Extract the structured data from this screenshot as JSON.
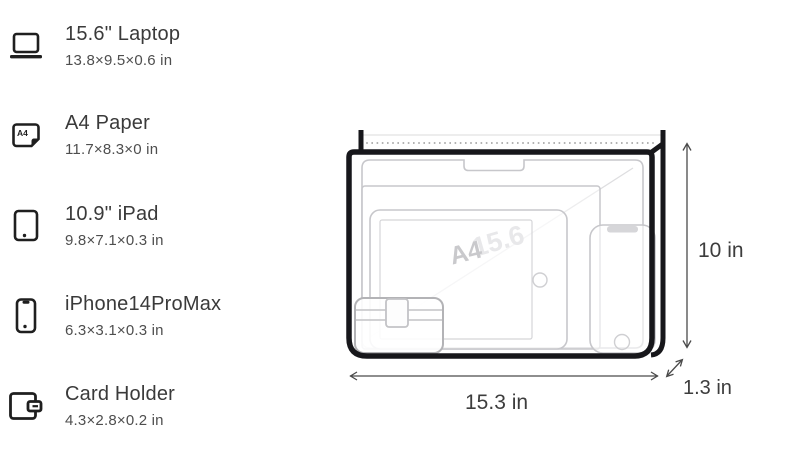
{
  "items": [
    {
      "name": "15.6\" Laptop",
      "dims": "13.8×9.5×0.6 in",
      "icon": "laptop-icon"
    },
    {
      "name": "A4 Paper",
      "dims": "11.7×8.3×0 in",
      "icon": "a4-paper-icon",
      "icon_label": "A4"
    },
    {
      "name": "10.9\" iPad",
      "dims": "9.8×7.1×0.3 in",
      "icon": "ipad-icon"
    },
    {
      "name": "iPhone14ProMax",
      "dims": "6.3×3.1×0.3 in",
      "icon": "iphone-icon"
    },
    {
      "name": "Card Holder",
      "dims": "4.3×2.8×0.2 in",
      "icon": "card-holder-icon"
    }
  ],
  "diagram": {
    "height_label": "10 in",
    "width_label": "15.3 in",
    "depth_label": "1.3 in",
    "watermark_paper": "A4",
    "watermark_diagonal": "15.6"
  },
  "colors": {
    "text_primary": "#3a3a3a",
    "text_secondary": "#4e4e4e",
    "bag_outline": "#17171b",
    "item_outline": "#c7c7cb",
    "card_holder_outline": "#b3b3b6",
    "dimension_lines": "#4a4a4a",
    "zipper_dots": "#9a9a9a",
    "watermark": "#c9c9cc"
  }
}
